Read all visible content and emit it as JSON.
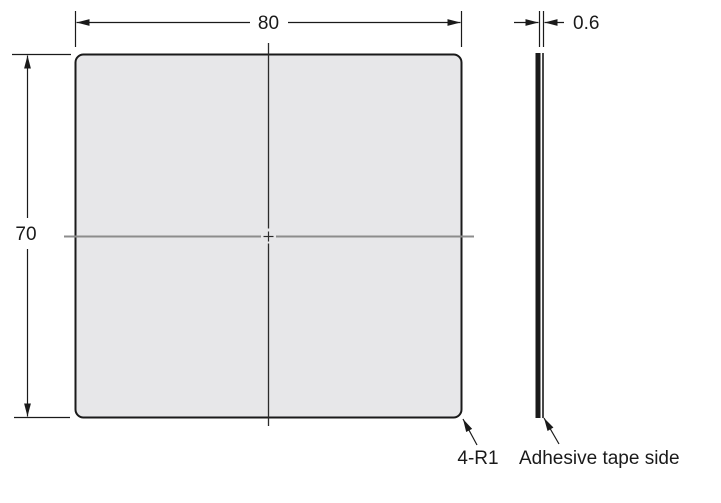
{
  "dimensions": {
    "width_label": "80",
    "height_label": "70",
    "thickness_label": "0.6"
  },
  "labels": {
    "corner_radius": "4-R1",
    "adhesive_side": "Adhesive tape side"
  },
  "colors": {
    "background": "#ffffff",
    "plate_fill": "#e7e7e9",
    "line": "#1a1a1a",
    "centerline": "#8c8c8c"
  }
}
